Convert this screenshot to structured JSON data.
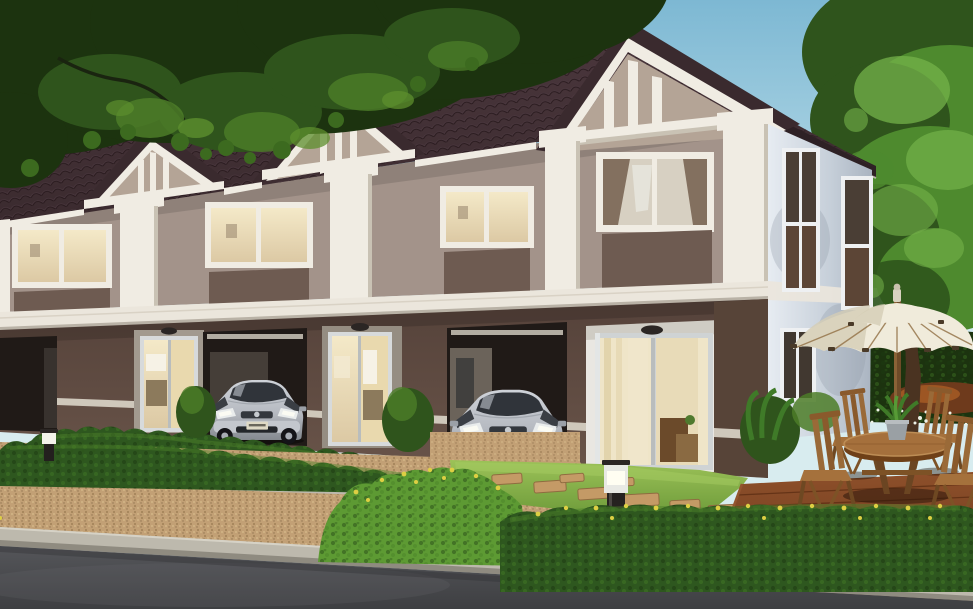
{
  "scene": {
    "description": "Dusk photorealistic rendering of a row of modern two-storey townhouses with dark brown tiled roofs and gabled dormers, taupe upper walls with white pilasters and glowing windows, dark brown ground floor with carports holding two silver hatchback cars and lit sliding glass doors, trimmed hedges and gravel driveways along an asphalt road, and a corner-unit garden with lawn, stepping stones, wooden deck, round table with four folding chairs under a cream patio umbrella, framed by overhanging tree foliage",
    "time_of_day": "dusk",
    "objects": {
      "townhouse_units_visible": 4,
      "roof_gables": 3,
      "upper_floor_windows": 4,
      "side_wall_windows": 3,
      "sliding_glass_doors": 3,
      "door_lamps": 3,
      "carports": 3,
      "cars": 2,
      "bollard_lights": 2,
      "hedge_rows": 4,
      "stepping_stones": 8,
      "patio_umbrellas": 1,
      "patio_tables": 1,
      "patio_chairs": 4,
      "potted_plants_on_table": 1,
      "trees": 2
    },
    "car_plate_hint": "PL 1786"
  },
  "palette": {
    "sky_top": "#7db8d3",
    "sky_horizon": "#cfe9f0",
    "roof": "#3a2a2e",
    "roof_tile_hi": "#4b373d",
    "roof_ridge": "#5a454c",
    "gable_infill": "#b4a496",
    "trim": "#f0ece3",
    "wall_upper": "#a3938a",
    "spandrel": "#6e5b51",
    "band": "#ebe6dc",
    "ground_wall": "#604c42",
    "carport_dark": "#201a17",
    "door_glow": "#f3e6c1",
    "frame_silver": "#d7dadb",
    "side_wall": "#d9dfe8",
    "glass_dark": "#453a33",
    "hedge": "#2e571f",
    "hedge_bright": "#5d9a33",
    "grass": "#7fae45",
    "gravel": "#c2a075",
    "curb": "#bdb9ad",
    "road": "#55565a",
    "road_dark": "#3e3f42",
    "deck": "#7c4424",
    "deck_seam": "#5a2c12",
    "wood": "#9a6a38",
    "wood_dark": "#714a20",
    "umbrella": "#f0ebdb",
    "umbrella_shade": "#d5cdb5",
    "umbrella_rib": "#96764c",
    "car_silver": "#b6bac1",
    "car_glass": "#30343a",
    "foliage_dark": "#1c330f",
    "foliage_mid": "#2f541c",
    "foliage_hi": "#4c7d28",
    "tree_green": "#4e8a2e",
    "tree_green_hi": "#74b24a",
    "trunk": "#4a3321",
    "flower_yellow": "#ddcf43",
    "flower_white": "#edf2e6",
    "lamp_black": "#2b2624"
  }
}
